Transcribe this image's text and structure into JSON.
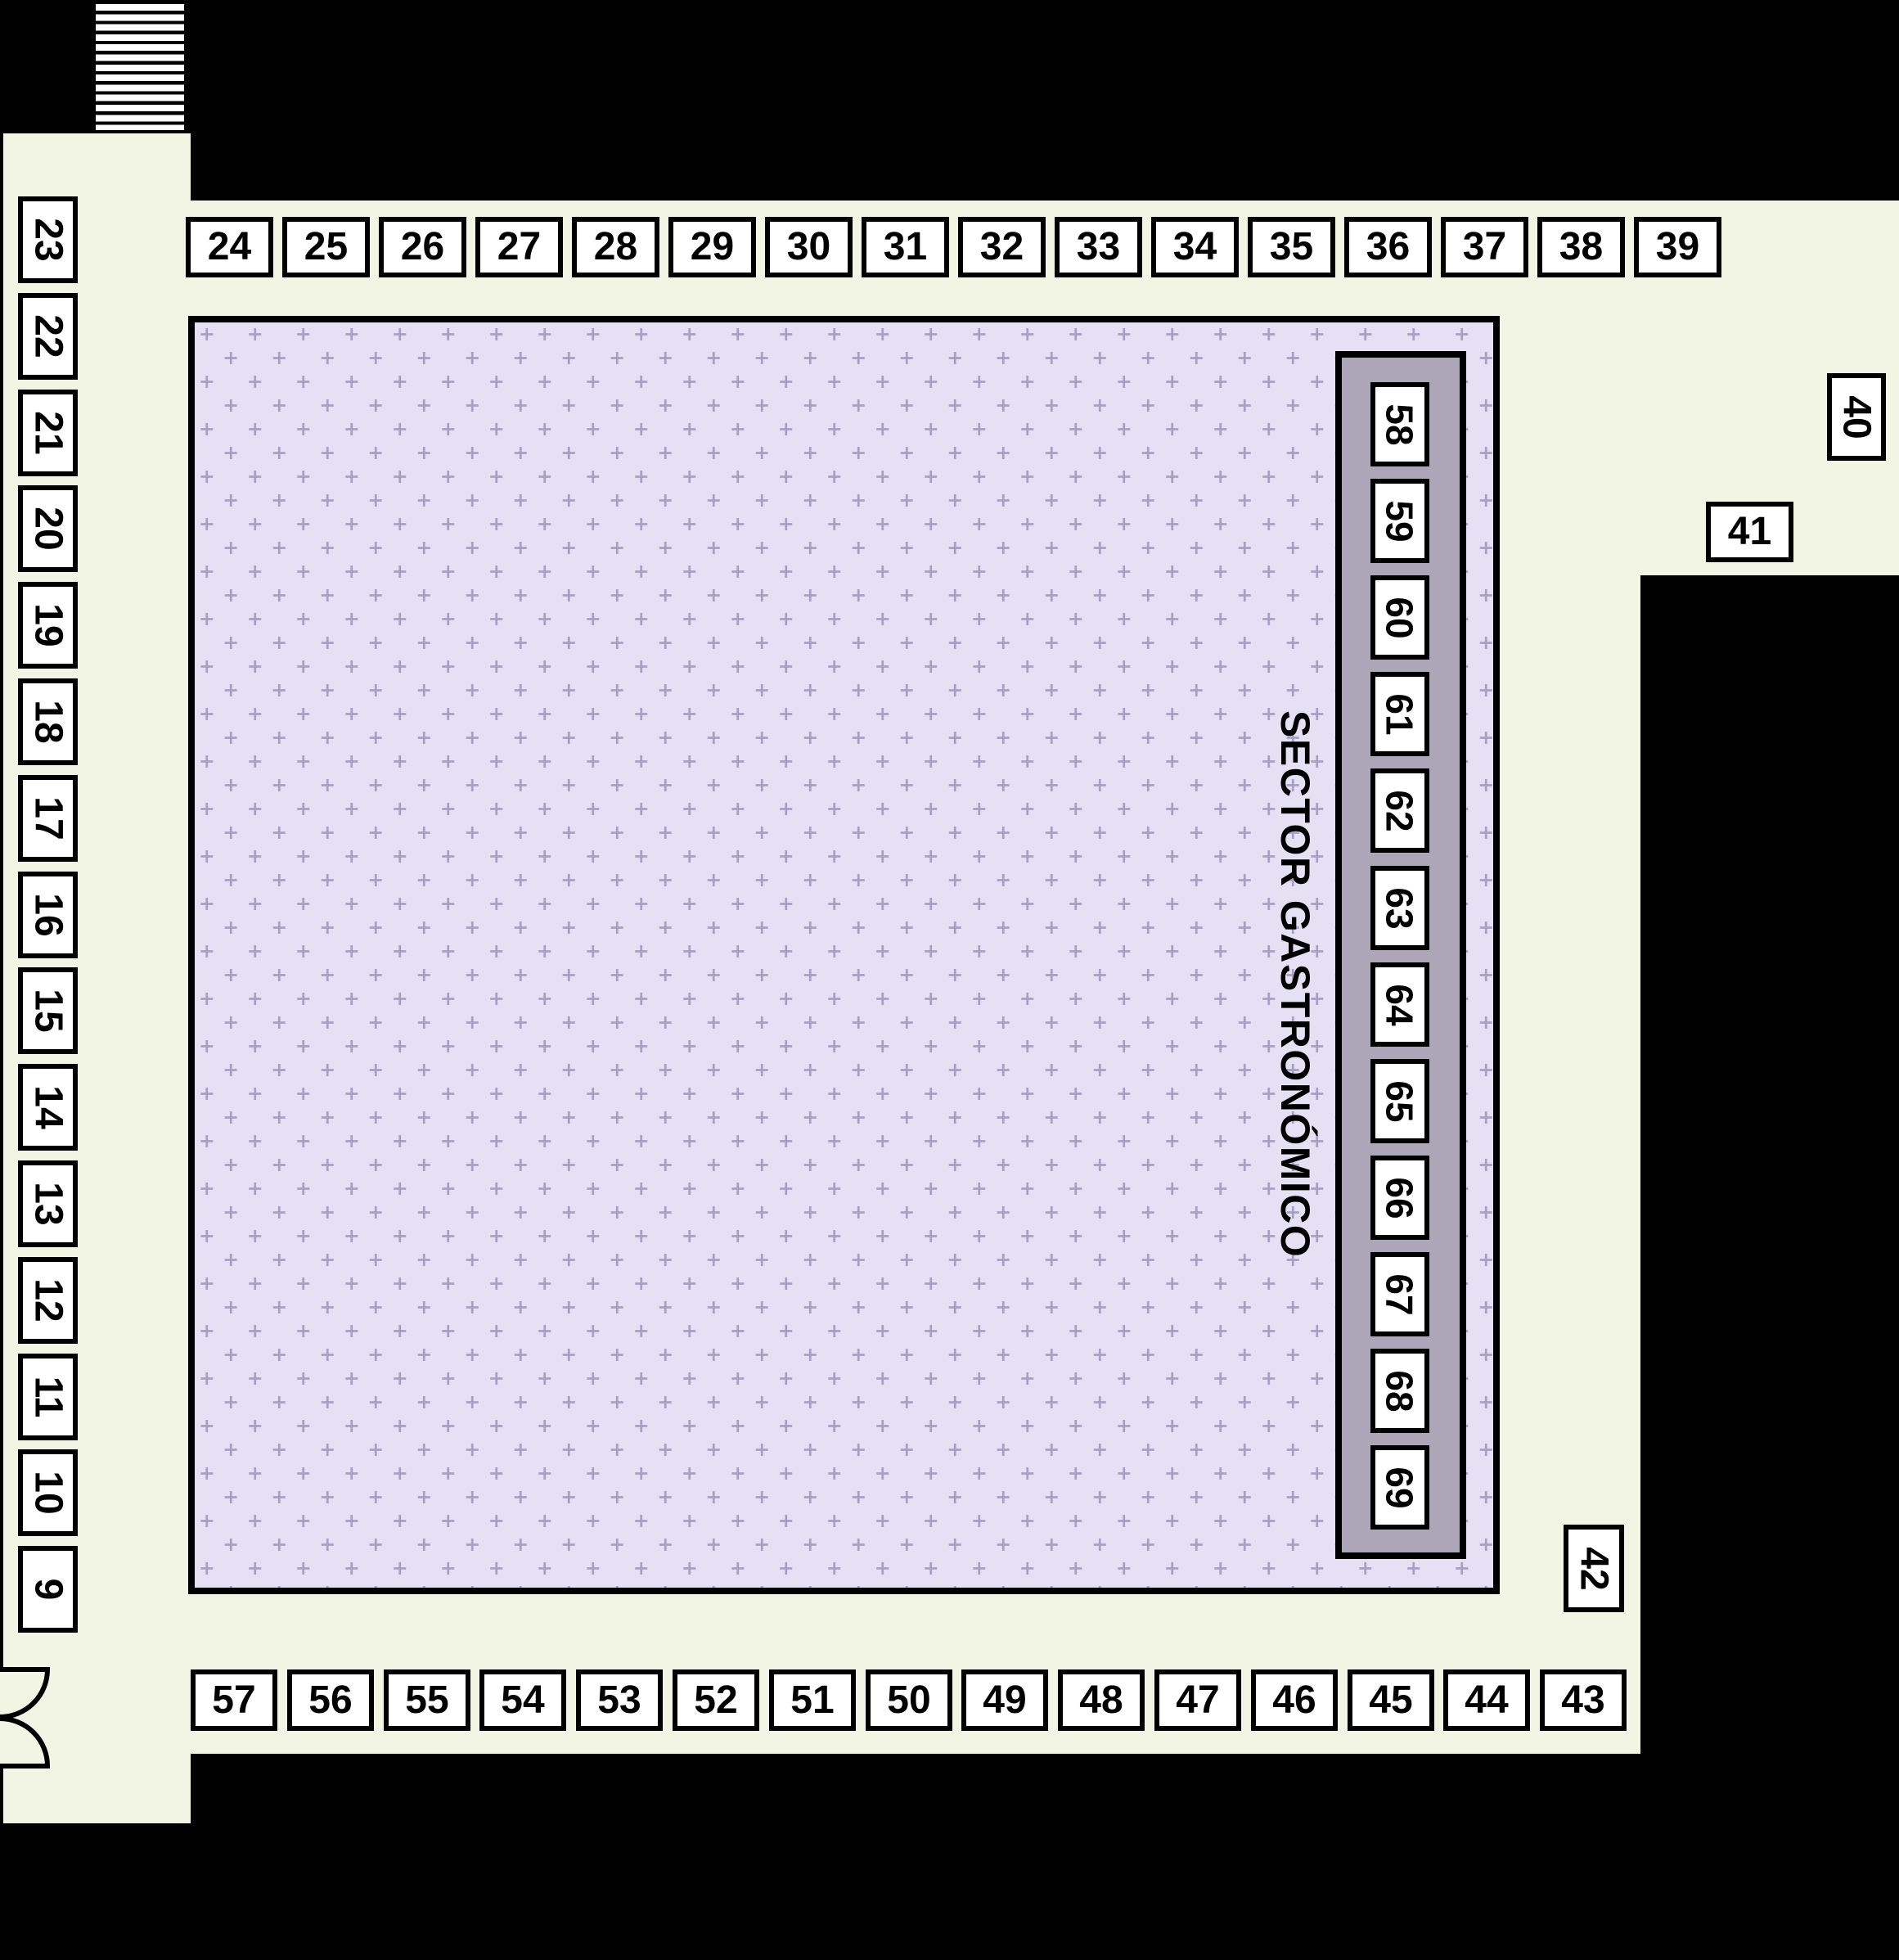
{
  "page": {
    "type": "venue floor plan"
  },
  "sector": {
    "label": "SECTOR GASTRONÓMICO"
  },
  "stalls": {
    "left_column": [
      "23",
      "22",
      "21",
      "20",
      "19",
      "18",
      "17",
      "16",
      "15",
      "14",
      "13",
      "12",
      "11",
      "10",
      "9"
    ],
    "top_row": [
      "24",
      "25",
      "26",
      "27",
      "28",
      "29",
      "30",
      "31",
      "32",
      "33",
      "34",
      "35",
      "36",
      "37",
      "38",
      "39"
    ],
    "bottom_row": [
      "57",
      "56",
      "55",
      "54",
      "53",
      "52",
      "51",
      "50",
      "49",
      "48",
      "47",
      "46",
      "45",
      "44",
      "43"
    ],
    "gastronomic_column": [
      "58",
      "59",
      "60",
      "61",
      "62",
      "63",
      "64",
      "65",
      "66",
      "67",
      "68",
      "69"
    ],
    "stall_40": "40",
    "stall_41": "41",
    "stall_42": "42"
  },
  "colors": {
    "background": "#000000",
    "floor": "#f2f5e3",
    "plaza": "#e6e0f5",
    "plaza_cross": "#a8a0c4",
    "gastro_strip": "#ada5b8",
    "stall_fill": "#ffffff",
    "outline": "#000000"
  }
}
